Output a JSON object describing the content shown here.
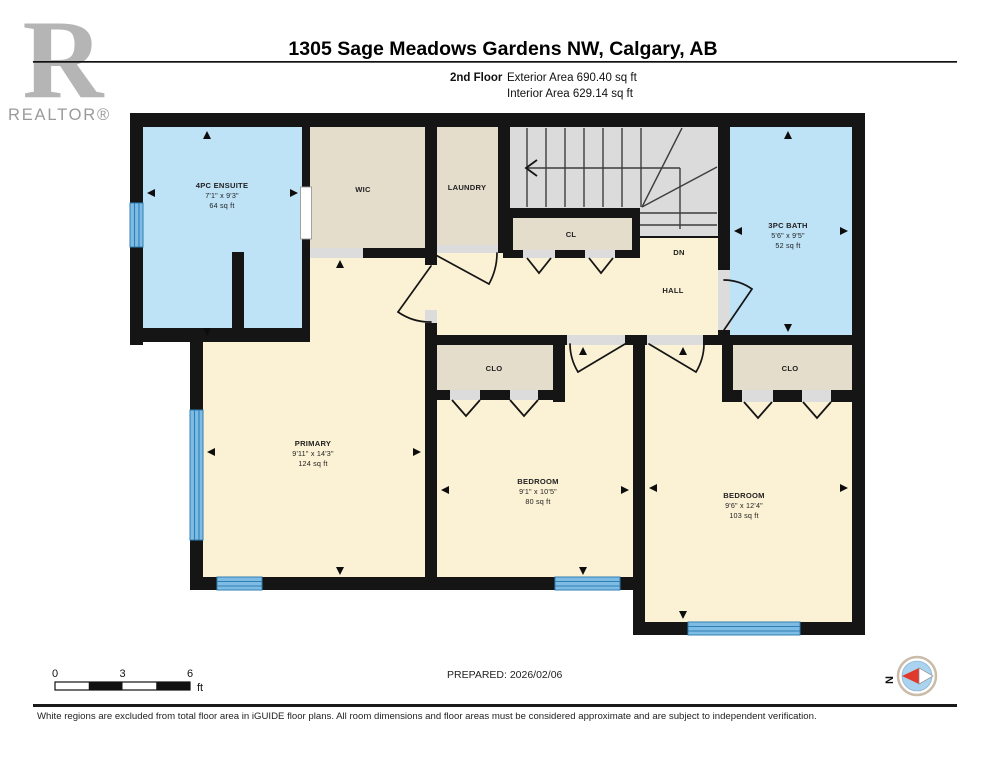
{
  "header": {
    "logo_letter": "R",
    "logo_text": "REALTOR®",
    "title": "1305 Sage Meadows Gardens NW, Calgary, AB",
    "floor_label": "2nd Floor",
    "exterior_area": "Exterior Area 690.40 sq ft",
    "interior_area": "Interior Area 629.14 sq ft"
  },
  "rooms": {
    "ensuite": {
      "name": "4PC ENSUITE",
      "dims": "7'1\" x 9'3\"",
      "area": "64 sq ft"
    },
    "wic": {
      "name": "WIC"
    },
    "laundry": {
      "name": "LAUNDRY"
    },
    "cl": {
      "name": "CL"
    },
    "dn": {
      "name": "DN"
    },
    "hall": {
      "name": "HALL"
    },
    "bath": {
      "name": "3PC BATH",
      "dims": "5'6\" x 9'5\"",
      "area": "52 sq ft"
    },
    "primary": {
      "name": "PRIMARY",
      "dims": "9'11\" x 14'3\"",
      "area": "124 sq ft"
    },
    "bedroom_mid": {
      "name": "BEDROOM",
      "dims": "9'1\" x 10'5\"",
      "area": "80 sq ft"
    },
    "bedroom_right": {
      "name": "BEDROOM",
      "dims": "9'6\" x 12'4\"",
      "area": "103 sq ft"
    },
    "clo_mid": {
      "name": "CLO"
    },
    "clo_right": {
      "name": "CLO"
    }
  },
  "footer": {
    "scale": {
      "t0": "0",
      "t3": "3",
      "t6": "6",
      "unit": "ft"
    },
    "prepared": "PREPARED: 2026/02/06",
    "compass_n": "N",
    "disclaimer": "White regions are excluded from total floor area in iGUIDE floor plans. All room dimensions and floor areas must be considered approximate and are subject to independent verification."
  },
  "colors": {
    "room_blue": "#BEE2F6",
    "room_cream": "#FBF1D4",
    "closet_tan": "#E5DDCB",
    "stair_gray": "#DBDBDB",
    "wall_black": "#151515",
    "window_blue": "#7FBCE4",
    "window_stripe": "#2F7FB5",
    "threshold_gray": "#DCDCDC",
    "compass_red": "#E03A2F",
    "compass_blue": "#A9D3EE"
  }
}
